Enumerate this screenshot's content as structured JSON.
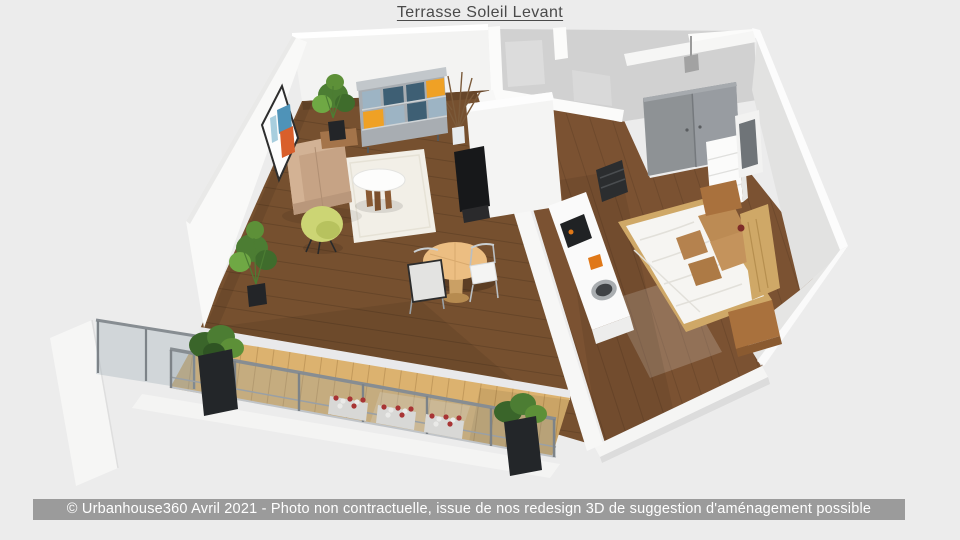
{
  "title": "Terrasse Soleil Levant",
  "footer": {
    "text": "© Urbanhouse360 Avril 2021 - Photo non contractuelle, issue de nos redesign 3D de suggestion d'aménagement possible"
  },
  "palette": {
    "background": "#ececec",
    "footer_bg": "#9b9b9b",
    "footer_text": "#ffffff",
    "title_color": "#4a4a4a",
    "wall_white": "#f9f9f8",
    "wall_inner": "#f3f3f2",
    "wall_stub": "#f4f4f3",
    "east_wall": "#e2e2e1",
    "hall_floor": "#d1d1d1",
    "living_floor": "#76502f",
    "bedroom_floor": "#7b5232",
    "deck_wood": "#dcb26f",
    "threshold": "#e9e9eb",
    "glass": "rgba(140,158,170,0.28)",
    "railing_metal": "#7d8388",
    "ledge_white": "#f4f4f3",
    "planter_dark": "#232629",
    "plant_green": "#4c7d33",
    "plant_green_light": "#6fa844",
    "flower_red": "#a83434",
    "sofa_beige": "#c6a385",
    "rug_ivory": "#f2efe7",
    "egg_chair": "#ccd574",
    "coffee_table_white": "#fdfdfc",
    "dining_table_wood": "#ecbe82",
    "shelf_slate": "#3e5f74",
    "shelf_lightblue": "#9db4c4",
    "shelf_orange": "#efa125",
    "shelf_frame": "#a8adb2",
    "art_blue": "#4f93b8",
    "art_orange": "#d95f2b",
    "wardrobe_gray": "#8e9295",
    "bed_white": "#f6f5f2",
    "pillow_tan": "#bc8b54",
    "headboard_wood": "#cfa867",
    "nightstand_wood": "#a9713d",
    "counter_white": "#fafafa",
    "appliance_dark": "#202224",
    "accent_orange": "#e07818",
    "tv_black": "#17181a"
  },
  "scene": {
    "type": "3d-floorplan-render",
    "objects": [
      "living-room",
      "terrace-deck",
      "glass-railing",
      "planters",
      "flower-boxes",
      "sofa",
      "rug",
      "coffee-table",
      "egg-chair",
      "bookshelf",
      "wall-art",
      "potted-plants",
      "dining-table",
      "dining-chairs",
      "kitchen-counter",
      "sink",
      "cooktop",
      "oven",
      "tv",
      "bedroom",
      "bed",
      "wardrobe",
      "dresser",
      "wall-tv",
      "hallway",
      "bathroom",
      "ceiling-lamp"
    ]
  }
}
